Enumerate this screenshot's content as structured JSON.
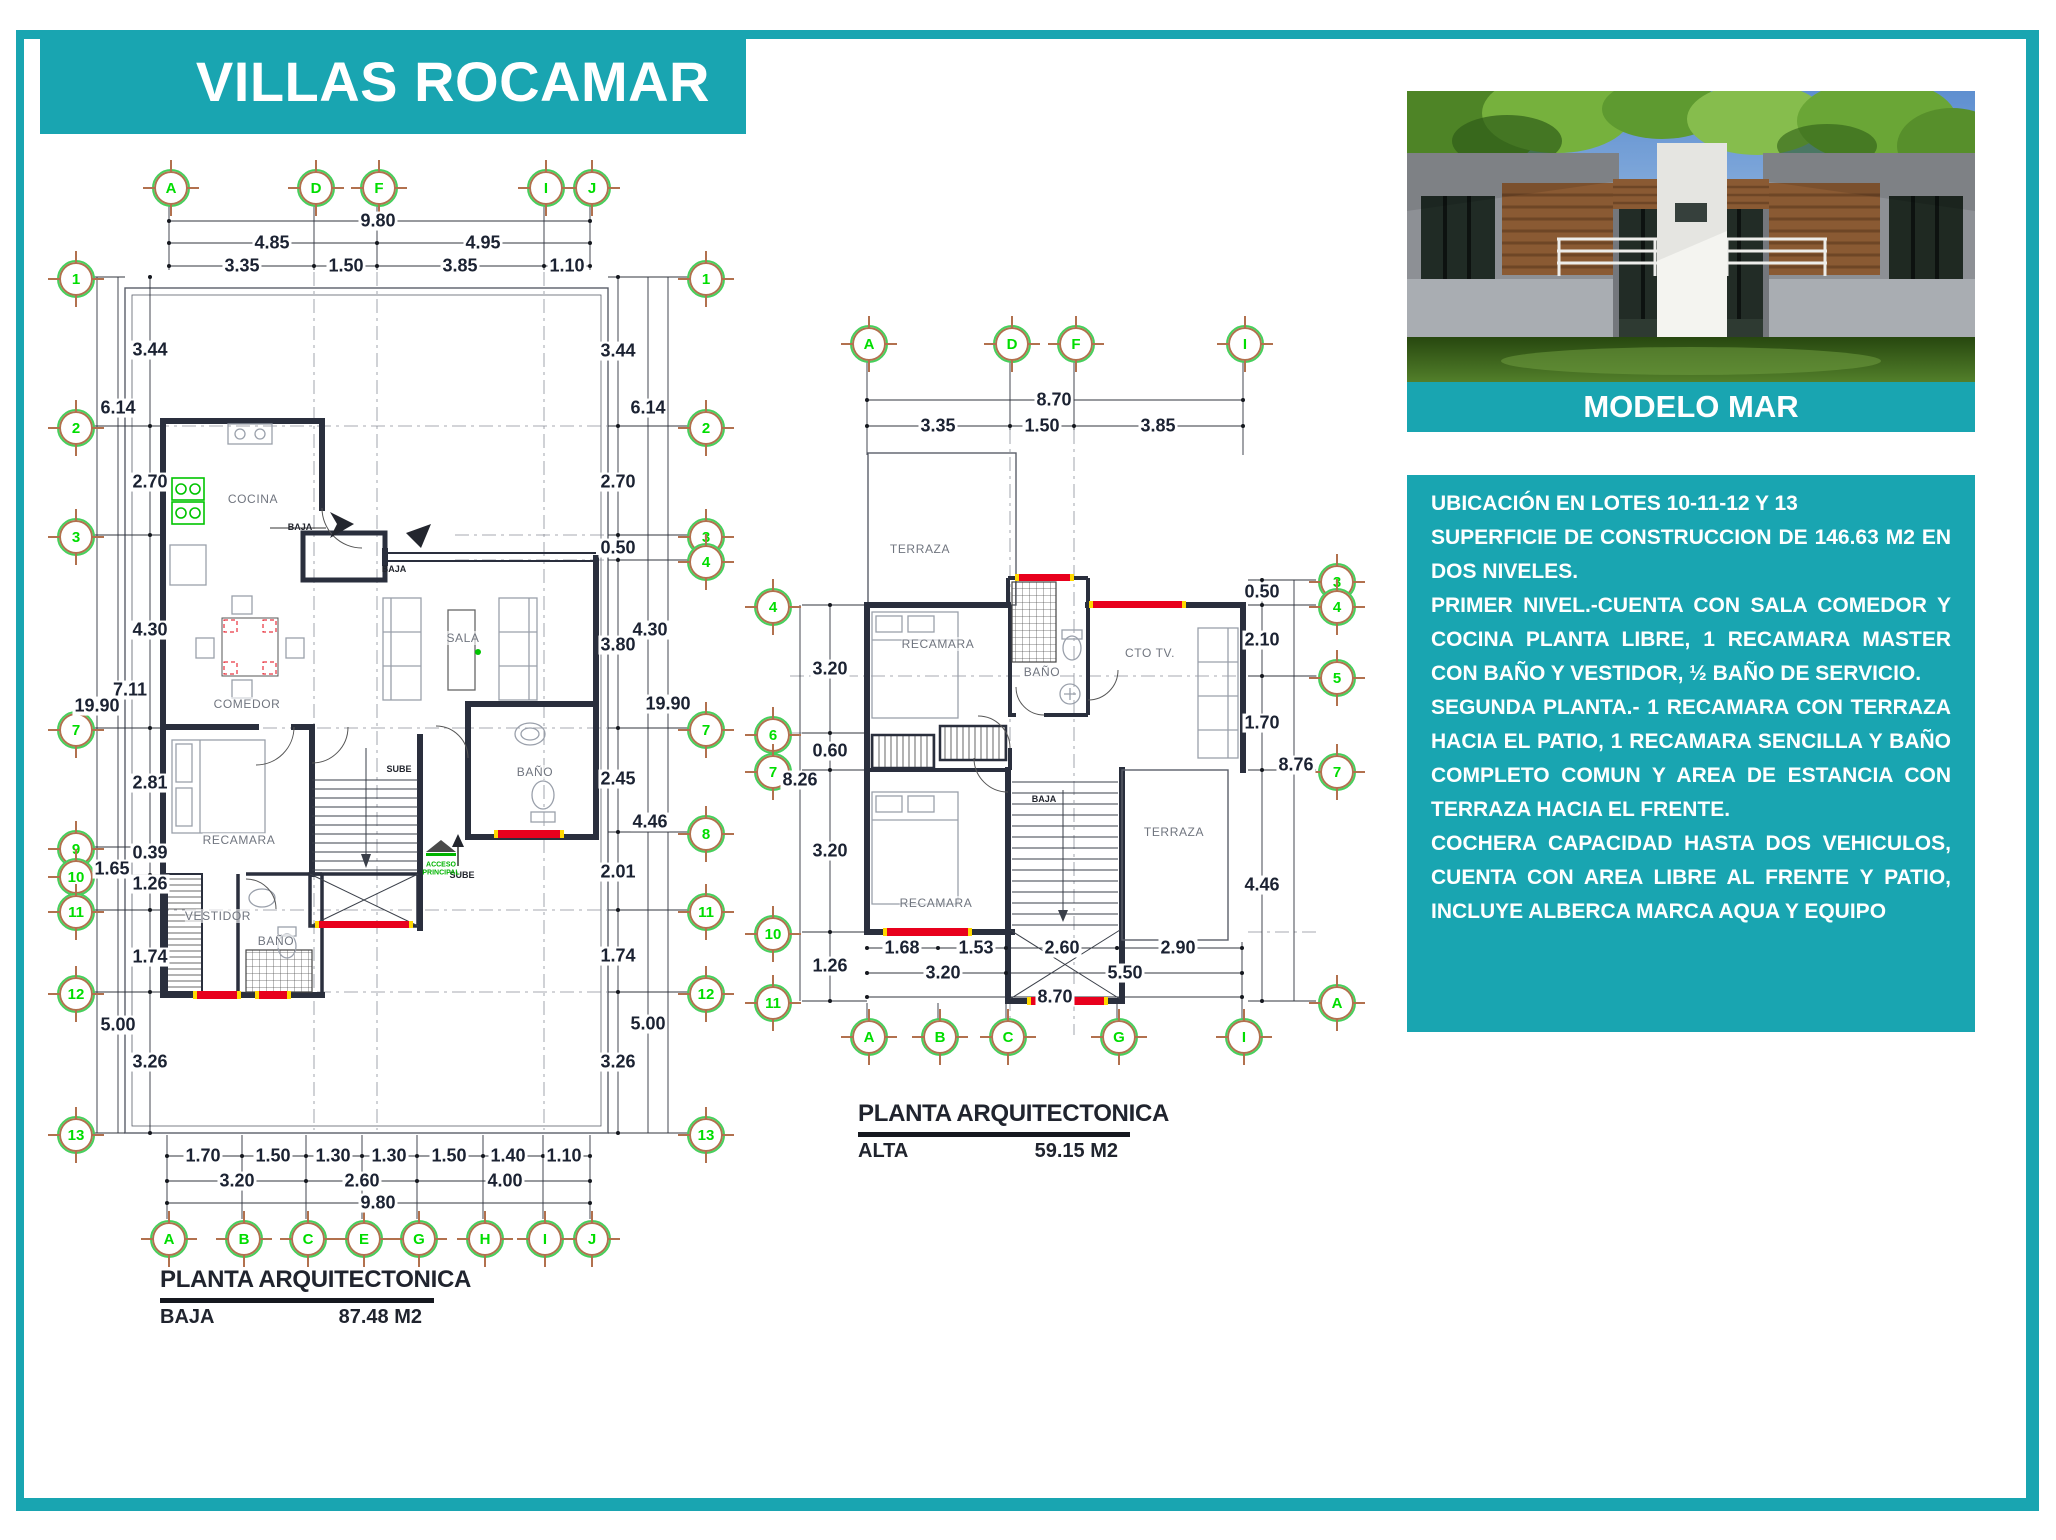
{
  "page": {
    "title": "VILLAS ROCAMAR",
    "colors": {
      "accent_teal": "#19A5B1",
      "bubble_green": "#00DD00",
      "crosshair_brown": "#B2714E",
      "wall_dark": "#2A2F3D",
      "window_red": "#E8001D",
      "window_yellow": "#FFD800",
      "cad_green": "#00C400"
    }
  },
  "model": {
    "caption": "MODELO MAR",
    "description": [
      "UBICACIÓN EN LOTES 10-11-12 Y 13",
      "SUPERFICIE DE CONSTRUCCION DE 146.63 M2 EN DOS NIVELES.",
      "PRIMER NIVEL.-CUENTA CON SALA COMEDOR Y COCINA PLANTA LIBRE, 1 RECAMARA MASTER CON BAÑO Y VESTIDOR, ½ BAÑO DE SERVICIO.",
      "SEGUNDA PLANTA.- 1 RECAMARA CON TERRAZA HACIA EL PATIO, 1 RECAMARA SENCILLA Y BAÑO COMPLETO COMUN Y AREA DE ESTANCIA CON TERRAZA HACIA EL FRENTE.",
      "COCHERA CAPACIDAD HASTA DOS VEHICULOS, CUENTA CON AREA LIBRE AL FRENTE Y PATIO, INCLUYE ALBERCA MARCA AQUA Y EQUIPO"
    ]
  },
  "plan_baja": {
    "title": "PLANTA ARQUITECTONICA",
    "level": "BAJA",
    "area": "87.48 M2",
    "bubbles": [
      {
        "t": "A",
        "x": 169,
        "y": 186
      },
      {
        "t": "D",
        "x": 314,
        "y": 186
      },
      {
        "t": "F",
        "x": 377,
        "y": 186
      },
      {
        "t": "I",
        "x": 544,
        "y": 186
      },
      {
        "t": "J",
        "x": 590,
        "y": 186
      },
      {
        "t": "1",
        "x": 74,
        "y": 277
      },
      {
        "t": "2",
        "x": 74,
        "y": 426
      },
      {
        "t": "3",
        "x": 74,
        "y": 535
      },
      {
        "t": "7",
        "x": 74,
        "y": 728
      },
      {
        "t": "9",
        "x": 74,
        "y": 847
      },
      {
        "t": "10",
        "x": 74,
        "y": 875
      },
      {
        "t": "11",
        "x": 74,
        "y": 910
      },
      {
        "t": "12",
        "x": 74,
        "y": 992
      },
      {
        "t": "13",
        "x": 74,
        "y": 1133
      },
      {
        "t": "1",
        "x": 704,
        "y": 277
      },
      {
        "t": "2",
        "x": 704,
        "y": 426
      },
      {
        "t": "3",
        "x": 704,
        "y": 535
      },
      {
        "t": "4",
        "x": 704,
        "y": 560
      },
      {
        "t": "7",
        "x": 704,
        "y": 728
      },
      {
        "t": "8",
        "x": 704,
        "y": 832
      },
      {
        "t": "11",
        "x": 704,
        "y": 910
      },
      {
        "t": "12",
        "x": 704,
        "y": 992
      },
      {
        "t": "13",
        "x": 704,
        "y": 1133
      },
      {
        "t": "A",
        "x": 167,
        "y": 1237
      },
      {
        "t": "B",
        "x": 242,
        "y": 1237
      },
      {
        "t": "C",
        "x": 306,
        "y": 1237
      },
      {
        "t": "E",
        "x": 362,
        "y": 1237
      },
      {
        "t": "G",
        "x": 417,
        "y": 1237
      },
      {
        "t": "H",
        "x": 483,
        "y": 1237
      },
      {
        "t": "I",
        "x": 543,
        "y": 1237
      },
      {
        "t": "J",
        "x": 590,
        "y": 1237
      }
    ],
    "dims": [
      {
        "t": "9.80",
        "x": 378,
        "y": 221
      },
      {
        "t": "4.85",
        "x": 272,
        "y": 243
      },
      {
        "t": "4.95",
        "x": 483,
        "y": 243
      },
      {
        "t": "3.35",
        "x": 242,
        "y": 266
      },
      {
        "t": "1.50",
        "x": 346,
        "y": 266
      },
      {
        "t": "3.85",
        "x": 460,
        "y": 266
      },
      {
        "t": "1.10",
        "x": 567,
        "y": 266
      },
      {
        "t": "3.44",
        "x": 150,
        "y": 350
      },
      {
        "t": "6.14",
        "x": 118,
        "y": 408
      },
      {
        "t": "2.70",
        "x": 150,
        "y": 482
      },
      {
        "t": "4.30",
        "x": 150,
        "y": 630
      },
      {
        "t": "7.11",
        "x": 130,
        "y": 690
      },
      {
        "t": "19.90",
        "x": 97,
        "y": 706
      },
      {
        "t": "2.81",
        "x": 150,
        "y": 783
      },
      {
        "t": "0.39",
        "x": 150,
        "y": 853
      },
      {
        "t": "1.65",
        "x": 112,
        "y": 869
      },
      {
        "t": "1.26",
        "x": 150,
        "y": 884
      },
      {
        "t": "1.74",
        "x": 150,
        "y": 957
      },
      {
        "t": "5.00",
        "x": 118,
        "y": 1025
      },
      {
        "t": "3.26",
        "x": 150,
        "y": 1062
      },
      {
        "t": "3.44",
        "x": 618,
        "y": 351
      },
      {
        "t": "6.14",
        "x": 648,
        "y": 408
      },
      {
        "t": "2.70",
        "x": 618,
        "y": 482
      },
      {
        "t": "0.50",
        "x": 618,
        "y": 548
      },
      {
        "t": "4.30",
        "x": 650,
        "y": 630
      },
      {
        "t": "3.80",
        "x": 618,
        "y": 645
      },
      {
        "t": "19.90",
        "x": 668,
        "y": 704
      },
      {
        "t": "2.45",
        "x": 618,
        "y": 779
      },
      {
        "t": "4.46",
        "x": 650,
        "y": 822
      },
      {
        "t": "2.01",
        "x": 618,
        "y": 872
      },
      {
        "t": "1.74",
        "x": 618,
        "y": 956
      },
      {
        "t": "5.00",
        "x": 648,
        "y": 1024
      },
      {
        "t": "3.26",
        "x": 618,
        "y": 1062
      },
      {
        "t": "1.70",
        "x": 203,
        "y": 1156
      },
      {
        "t": "1.50",
        "x": 273,
        "y": 1156
      },
      {
        "t": "1.30",
        "x": 333,
        "y": 1156
      },
      {
        "t": "1.30",
        "x": 389,
        "y": 1156
      },
      {
        "t": "1.50",
        "x": 449,
        "y": 1156
      },
      {
        "t": "1.40",
        "x": 508,
        "y": 1156
      },
      {
        "t": "1.10",
        "x": 564,
        "y": 1156
      },
      {
        "t": "3.20",
        "x": 237,
        "y": 1181
      },
      {
        "t": "2.60",
        "x": 362,
        "y": 1181
      },
      {
        "t": "4.00",
        "x": 505,
        "y": 1181
      },
      {
        "t": "9.80",
        "x": 378,
        "y": 1203
      }
    ],
    "rooms": [
      {
        "t": "COCINA",
        "x": 253,
        "y": 499
      },
      {
        "t": "COMEDOR",
        "x": 247,
        "y": 704
      },
      {
        "t": "SALA",
        "x": 463,
        "y": 638
      },
      {
        "t": "RECAMARA",
        "x": 239,
        "y": 840
      },
      {
        "t": "VESTIDOR",
        "x": 218,
        "y": 916
      },
      {
        "t": "BAÑO",
        "x": 276,
        "y": 941
      },
      {
        "t": "BAÑO",
        "x": 535,
        "y": 772
      }
    ],
    "notes": [
      {
        "t": "BAJA",
        "x": 300,
        "y": 528
      },
      {
        "t": "BAJA",
        "x": 394,
        "y": 570
      },
      {
        "t": "SUBE",
        "x": 399,
        "y": 770
      },
      {
        "t": "SUBE",
        "x": 462,
        "y": 876
      },
      {
        "t": "ACCESO\nPRINCIPAL",
        "x": 441,
        "y": 869,
        "c": "#00B400",
        "s": 7
      }
    ]
  },
  "plan_alta": {
    "title": "PLANTA ARQUITECTONICA",
    "level": "ALTA",
    "area": "59.15 M2",
    "bubbles": [
      {
        "t": "A",
        "x": 867,
        "y": 342
      },
      {
        "t": "D",
        "x": 1010,
        "y": 342
      },
      {
        "t": "F",
        "x": 1074,
        "y": 342
      },
      {
        "t": "I",
        "x": 1243,
        "y": 342
      },
      {
        "t": "4",
        "x": 771,
        "y": 605
      },
      {
        "t": "6",
        "x": 771,
        "y": 733
      },
      {
        "t": "7",
        "x": 771,
        "y": 770
      },
      {
        "t": "10",
        "x": 771,
        "y": 932
      },
      {
        "t": "11",
        "x": 771,
        "y": 1001
      },
      {
        "t": "3",
        "x": 1335,
        "y": 580
      },
      {
        "t": "4",
        "x": 1335,
        "y": 605
      },
      {
        "t": "5",
        "x": 1335,
        "y": 676
      },
      {
        "t": "7",
        "x": 1335,
        "y": 770
      },
      {
        "t": "A",
        "x": 1335,
        "y": 1001
      },
      {
        "t": "A",
        "x": 867,
        "y": 1035
      },
      {
        "t": "B",
        "x": 938,
        "y": 1035
      },
      {
        "t": "C",
        "x": 1006,
        "y": 1035
      },
      {
        "t": "G",
        "x": 1117,
        "y": 1035
      },
      {
        "t": "I",
        "x": 1242,
        "y": 1035
      }
    ],
    "dims": [
      {
        "t": "8.70",
        "x": 1054,
        "y": 400
      },
      {
        "t": "3.35",
        "x": 938,
        "y": 426
      },
      {
        "t": "1.50",
        "x": 1042,
        "y": 426
      },
      {
        "t": "3.85",
        "x": 1158,
        "y": 426
      },
      {
        "t": "3.20",
        "x": 830,
        "y": 669
      },
      {
        "t": "0.60",
        "x": 830,
        "y": 751
      },
      {
        "t": "8.26",
        "x": 800,
        "y": 780
      },
      {
        "t": "3.20",
        "x": 830,
        "y": 851
      },
      {
        "t": "1.26",
        "x": 830,
        "y": 966
      },
      {
        "t": "0.50",
        "x": 1262,
        "y": 592
      },
      {
        "t": "2.10",
        "x": 1262,
        "y": 640
      },
      {
        "t": "1.70",
        "x": 1262,
        "y": 723
      },
      {
        "t": "8.76",
        "x": 1296,
        "y": 765
      },
      {
        "t": "4.46",
        "x": 1262,
        "y": 885
      },
      {
        "t": "1.68",
        "x": 902,
        "y": 948
      },
      {
        "t": "1.53",
        "x": 976,
        "y": 948
      },
      {
        "t": "2.60",
        "x": 1062,
        "y": 948
      },
      {
        "t": "2.90",
        "x": 1178,
        "y": 948
      },
      {
        "t": "3.20",
        "x": 943,
        "y": 973
      },
      {
        "t": "5.50",
        "x": 1125,
        "y": 973
      },
      {
        "t": "8.70",
        "x": 1055,
        "y": 997
      }
    ],
    "rooms": [
      {
        "t": "TERRAZA",
        "x": 920,
        "y": 549
      },
      {
        "t": "RECAMARA",
        "x": 938,
        "y": 644
      },
      {
        "t": "BAÑO",
        "x": 1042,
        "y": 672
      },
      {
        "t": "CTO TV.",
        "x": 1150,
        "y": 653
      },
      {
        "t": "RECAMARA",
        "x": 936,
        "y": 903
      },
      {
        "t": "TERRAZA",
        "x": 1174,
        "y": 832
      }
    ],
    "notes": [
      {
        "t": "BAJA",
        "x": 1044,
        "y": 800
      }
    ]
  }
}
